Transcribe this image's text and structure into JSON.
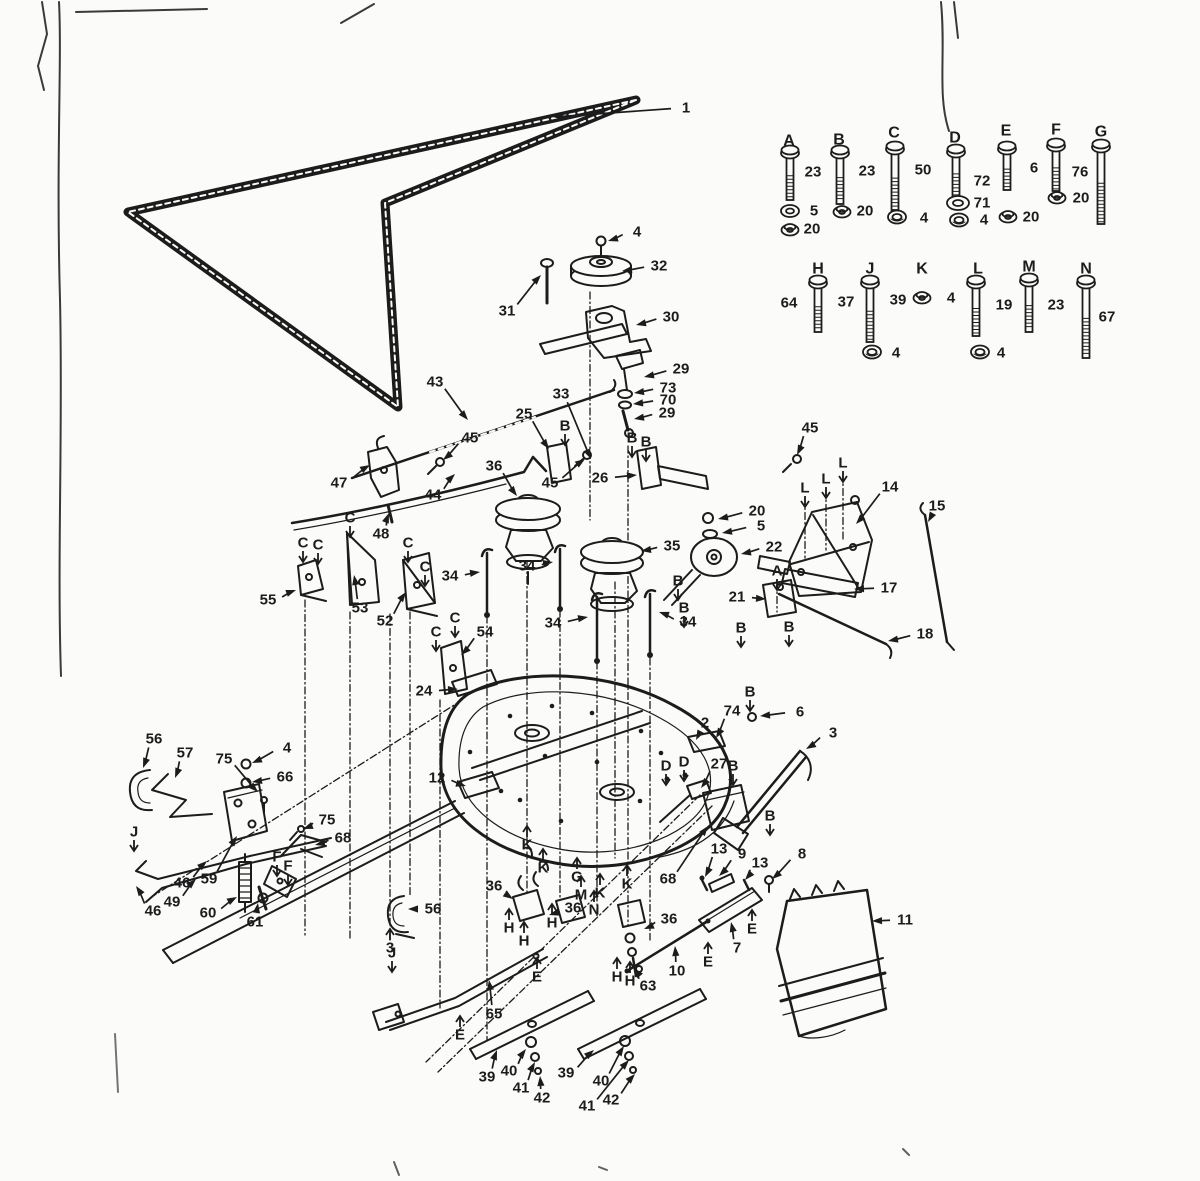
{
  "colors": {
    "ink": "#1c1c1c",
    "paper": "#fbfbf9",
    "scan": "#3a3a3a"
  },
  "legend": {
    "letters": [
      {
        "t": "A",
        "x": 789,
        "y": 141
      },
      {
        "t": "B",
        "x": 839,
        "y": 140
      },
      {
        "t": "C",
        "x": 894,
        "y": 133
      },
      {
        "t": "D",
        "x": 955,
        "y": 138
      },
      {
        "t": "E",
        "x": 1006,
        "y": 131
      },
      {
        "t": "F",
        "x": 1056,
        "y": 130
      },
      {
        "t": "G",
        "x": 1101,
        "y": 132
      },
      {
        "t": "H",
        "x": 818,
        "y": 269
      },
      {
        "t": "J",
        "x": 870,
        "y": 269
      },
      {
        "t": "K",
        "x": 922,
        "y": 269
      },
      {
        "t": "L",
        "x": 978,
        "y": 269
      },
      {
        "t": "M",
        "x": 1029,
        "y": 267
      },
      {
        "t": "N",
        "x": 1086,
        "y": 269
      }
    ],
    "numbers": [
      {
        "t": "23",
        "x": 813,
        "y": 172
      },
      {
        "t": "5",
        "x": 814,
        "y": 211
      },
      {
        "t": "20",
        "x": 812,
        "y": 229
      },
      {
        "t": "23",
        "x": 867,
        "y": 171
      },
      {
        "t": "20",
        "x": 865,
        "y": 211
      },
      {
        "t": "50",
        "x": 923,
        "y": 170
      },
      {
        "t": "4",
        "x": 924,
        "y": 218
      },
      {
        "t": "72",
        "x": 982,
        "y": 181
      },
      {
        "t": "71",
        "x": 982,
        "y": 203
      },
      {
        "t": "4",
        "x": 984,
        "y": 220
      },
      {
        "t": "6",
        "x": 1034,
        "y": 168
      },
      {
        "t": "20",
        "x": 1031,
        "y": 217
      },
      {
        "t": "76",
        "x": 1080,
        "y": 172
      },
      {
        "t": "20",
        "x": 1081,
        "y": 198
      },
      {
        "t": "64",
        "x": 789,
        "y": 303
      },
      {
        "t": "37",
        "x": 846,
        "y": 302
      },
      {
        "t": "39",
        "x": 898,
        "y": 300
      },
      {
        "t": "4",
        "x": 951,
        "y": 298
      },
      {
        "t": "19",
        "x": 1004,
        "y": 305
      },
      {
        "t": "23",
        "x": 1056,
        "y": 305
      },
      {
        "t": "67",
        "x": 1107,
        "y": 317
      },
      {
        "t": "4",
        "x": 896,
        "y": 353
      },
      {
        "t": "4",
        "x": 1001,
        "y": 353
      }
    ],
    "icons": [
      {
        "k": "bolt",
        "x": 790,
        "y": 152,
        "len": 44
      },
      {
        "k": "washer",
        "x": 790,
        "y": 211
      },
      {
        "k": "locknut",
        "x": 790,
        "y": 229
      },
      {
        "k": "bolt",
        "x": 840,
        "y": 152,
        "len": 48
      },
      {
        "k": "locknut",
        "x": 842,
        "y": 211
      },
      {
        "k": "bolt",
        "x": 895,
        "y": 148,
        "len": 58
      },
      {
        "k": "nut",
        "x": 897,
        "y": 217
      },
      {
        "k": "bolt",
        "x": 956,
        "y": 151,
        "len": 42
      },
      {
        "k": "flatwasher",
        "x": 958,
        "y": 203
      },
      {
        "k": "nut",
        "x": 959,
        "y": 220
      },
      {
        "k": "bolt",
        "x": 1007,
        "y": 148,
        "len": 38
      },
      {
        "k": "locknut",
        "x": 1008,
        "y": 216
      },
      {
        "k": "bolt",
        "x": 1056,
        "y": 145,
        "len": 42
      },
      {
        "k": "locknut",
        "x": 1057,
        "y": 197
      },
      {
        "k": "bolt",
        "x": 1101,
        "y": 146,
        "len": 74
      },
      {
        "k": "bolt",
        "x": 818,
        "y": 282,
        "len": 46
      },
      {
        "k": "bolt",
        "x": 870,
        "y": 282,
        "len": 56
      },
      {
        "k": "nut",
        "x": 872,
        "y": 352
      },
      {
        "k": "locknut",
        "x": 922,
        "y": 297
      },
      {
        "k": "bolt",
        "x": 976,
        "y": 282,
        "len": 50
      },
      {
        "k": "nut",
        "x": 980,
        "y": 352
      },
      {
        "k": "bolt",
        "x": 1029,
        "y": 280,
        "len": 48
      },
      {
        "k": "bolt",
        "x": 1086,
        "y": 282,
        "len": 72
      }
    ]
  },
  "callouts": [
    {
      "t": "1",
      "x": 686,
      "y": 108,
      "lx": 553,
      "ly": 117
    },
    {
      "t": "4",
      "x": 637,
      "y": 232,
      "lx": 608,
      "ly": 241
    },
    {
      "t": "32",
      "x": 659,
      "y": 266,
      "lx": 622,
      "ly": 271
    },
    {
      "t": "31",
      "x": 507,
      "y": 311,
      "lx": 541,
      "ly": 275
    },
    {
      "t": "30",
      "x": 671,
      "y": 317,
      "lx": 636,
      "ly": 325
    },
    {
      "t": "29",
      "x": 681,
      "y": 369,
      "lx": 644,
      "ly": 377
    },
    {
      "t": "73",
      "x": 668,
      "y": 388,
      "lx": 634,
      "ly": 393
    },
    {
      "t": "70",
      "x": 668,
      "y": 400,
      "lx": 633,
      "ly": 404
    },
    {
      "t": "29",
      "x": 667,
      "y": 413,
      "lx": 634,
      "ly": 419
    },
    {
      "t": "33",
      "x": 561,
      "y": 394,
      "lx": 591,
      "ly": 459
    },
    {
      "t": "25",
      "x": 524,
      "y": 414,
      "lx": 549,
      "ly": 449
    },
    {
      "t": "43",
      "x": 435,
      "y": 382,
      "lx": 468,
      "ly": 420
    },
    {
      "t": "45",
      "x": 470,
      "y": 438,
      "lx": 443,
      "ly": 460
    },
    {
      "t": "36",
      "x": 494,
      "y": 466,
      "lx": 517,
      "ly": 496
    },
    {
      "t": "44",
      "x": 433,
      "y": 495,
      "lx": 455,
      "ly": 474
    },
    {
      "t": "47",
      "x": 339,
      "y": 483,
      "lx": 370,
      "ly": 465
    },
    {
      "t": "48",
      "x": 381,
      "y": 534,
      "lx": 389,
      "ly": 513
    },
    {
      "t": "26",
      "x": 600,
      "y": 478,
      "lx": 637,
      "ly": 475
    },
    {
      "t": "45",
      "x": 550,
      "y": 483,
      "lx": 585,
      "ly": 459
    },
    {
      "t": "45",
      "x": 810,
      "y": 428,
      "lx": 797,
      "ly": 455
    },
    {
      "t": "14",
      "x": 890,
      "y": 487,
      "lx": 856,
      "ly": 524
    },
    {
      "t": "15",
      "x": 937,
      "y": 506,
      "lx": 928,
      "ly": 522
    },
    {
      "t": "17",
      "x": 889,
      "y": 588,
      "lx": 854,
      "ly": 589
    },
    {
      "t": "18",
      "x": 925,
      "y": 634,
      "lx": 888,
      "ly": 641
    },
    {
      "t": "21",
      "x": 737,
      "y": 597,
      "lx": 766,
      "ly": 599
    },
    {
      "t": "22",
      "x": 774,
      "y": 547,
      "lx": 741,
      "ly": 554
    },
    {
      "t": "5",
      "x": 761,
      "y": 526,
      "lx": 722,
      "ly": 533
    },
    {
      "t": "20",
      "x": 757,
      "y": 511,
      "lx": 718,
      "ly": 519
    },
    {
      "t": "35",
      "x": 672,
      "y": 546,
      "lx": 641,
      "ly": 551
    },
    {
      "t": "34",
      "x": 450,
      "y": 576,
      "lx": 480,
      "ly": 572
    },
    {
      "t": "34",
      "x": 527,
      "y": 566,
      "lx": 553,
      "ly": 562
    },
    {
      "t": "34",
      "x": 553,
      "y": 623,
      "lx": 588,
      "ly": 617
    },
    {
      "t": "34",
      "x": 688,
      "y": 622,
      "lx": 659,
      "ly": 612
    },
    {
      "t": "55",
      "x": 268,
      "y": 600,
      "lx": 296,
      "ly": 590
    },
    {
      "t": "53",
      "x": 360,
      "y": 608,
      "lx": 354,
      "ly": 575
    },
    {
      "t": "52",
      "x": 385,
      "y": 621,
      "lx": 406,
      "ly": 592
    },
    {
      "t": "54",
      "x": 485,
      "y": 632,
      "lx": 461,
      "ly": 655
    },
    {
      "t": "24",
      "x": 424,
      "y": 691,
      "lx": 458,
      "ly": 689
    },
    {
      "t": "12",
      "x": 437,
      "y": 778,
      "lx": 466,
      "ly": 786
    },
    {
      "t": "2",
      "x": 705,
      "y": 723,
      "lx": 696,
      "ly": 740
    },
    {
      "t": "74",
      "x": 732,
      "y": 711,
      "lx": 716,
      "ly": 738
    },
    {
      "t": "6",
      "x": 800,
      "y": 712,
      "lx": 760,
      "ly": 716
    },
    {
      "t": "27",
      "x": 719,
      "y": 764,
      "lx": 701,
      "ly": 788
    },
    {
      "t": "3",
      "x": 833,
      "y": 733,
      "lx": 806,
      "ly": 749
    },
    {
      "t": "68",
      "x": 668,
      "y": 879,
      "lx": 708,
      "ly": 826
    },
    {
      "t": "13",
      "x": 719,
      "y": 849,
      "lx": 705,
      "ly": 877
    },
    {
      "t": "9",
      "x": 742,
      "y": 854,
      "lx": 719,
      "ly": 876
    },
    {
      "t": "13",
      "x": 760,
      "y": 863,
      "lx": 745,
      "ly": 880
    },
    {
      "t": "8",
      "x": 802,
      "y": 854,
      "lx": 772,
      "ly": 879
    },
    {
      "t": "11",
      "x": 905,
      "y": 920,
      "lx": 872,
      "ly": 921
    },
    {
      "t": "7",
      "x": 737,
      "y": 948,
      "lx": 731,
      "ly": 922
    },
    {
      "t": "10",
      "x": 677,
      "y": 971,
      "lx": 675,
      "ly": 946
    },
    {
      "t": "36",
      "x": 494,
      "y": 886,
      "lx": 513,
      "ly": 899
    },
    {
      "t": "36",
      "x": 573,
      "y": 908,
      "lx": 549,
      "ly": 915
    },
    {
      "t": "36",
      "x": 669,
      "y": 919,
      "lx": 644,
      "ly": 929
    },
    {
      "t": "63",
      "x": 648,
      "y": 986,
      "lx": 634,
      "ly": 968
    },
    {
      "t": "65",
      "x": 494,
      "y": 1014,
      "lx": 489,
      "ly": 980
    },
    {
      "t": "56",
      "x": 154,
      "y": 739,
      "lx": 143,
      "ly": 768
    },
    {
      "t": "57",
      "x": 185,
      "y": 753,
      "lx": 175,
      "ly": 778
    },
    {
      "t": "75",
      "x": 224,
      "y": 759,
      "lx": 258,
      "ly": 792
    },
    {
      "t": "4",
      "x": 287,
      "y": 748,
      "lx": 252,
      "ly": 763
    },
    {
      "t": "66",
      "x": 285,
      "y": 777,
      "lx": 252,
      "ly": 782
    },
    {
      "t": "75",
      "x": 327,
      "y": 820,
      "lx": 303,
      "ly": 829
    },
    {
      "t": "68",
      "x": 343,
      "y": 838,
      "lx": 315,
      "ly": 845
    },
    {
      "t": "59",
      "x": 209,
      "y": 879,
      "lx": 237,
      "ly": 836
    },
    {
      "t": "46",
      "x": 182,
      "y": 883,
      "lx": 207,
      "ly": 861
    },
    {
      "t": "49",
      "x": 172,
      "y": 902,
      "lx": 196,
      "ly": 879
    },
    {
      "t": "46",
      "x": 153,
      "y": 911,
      "lx": 136,
      "ly": 886
    },
    {
      "t": "60",
      "x": 208,
      "y": 913,
      "lx": 237,
      "ly": 897
    },
    {
      "t": "61",
      "x": 255,
      "y": 922,
      "lx": 258,
      "ly": 903
    },
    {
      "t": "56",
      "x": 433,
      "y": 909,
      "lx": 408,
      "ly": 909
    },
    {
      "t": "3",
      "x": 390,
      "y": 948,
      "dir": "u"
    },
    {
      "t": "39",
      "x": 487,
      "y": 1077,
      "lx": 497,
      "ly": 1050
    },
    {
      "t": "40",
      "x": 509,
      "y": 1071,
      "lx": 526,
      "ly": 1049
    },
    {
      "t": "41",
      "x": 521,
      "y": 1088,
      "lx": 535,
      "ly": 1062
    },
    {
      "t": "42",
      "x": 542,
      "y": 1098,
      "lx": 540,
      "ly": 1076
    },
    {
      "t": "39",
      "x": 566,
      "y": 1073,
      "lx": 594,
      "ly": 1050
    },
    {
      "t": "40",
      "x": 601,
      "y": 1081,
      "lx": 624,
      "ly": 1046
    },
    {
      "t": "41",
      "x": 587,
      "y": 1106,
      "lx": 629,
      "ly": 1060
    },
    {
      "t": "42",
      "x": 611,
      "y": 1100,
      "lx": 635,
      "ly": 1074
    },
    {
      "t": "B",
      "x": 565,
      "y": 426,
      "dir": "d"
    },
    {
      "t": "B",
      "x": 632,
      "y": 438,
      "dir": "d"
    },
    {
      "t": "B",
      "x": 646,
      "y": 442,
      "dir": "d"
    },
    {
      "t": "B",
      "x": 750,
      "y": 692,
      "dir": "d"
    },
    {
      "t": "B",
      "x": 733,
      "y": 766,
      "dir": "d"
    },
    {
      "t": "B",
      "x": 678,
      "y": 581,
      "dir": "d"
    },
    {
      "t": "B",
      "x": 684,
      "y": 608,
      "dir": "d"
    },
    {
      "t": "B",
      "x": 741,
      "y": 628,
      "dir": "d"
    },
    {
      "t": "B",
      "x": 789,
      "y": 627,
      "dir": "d"
    },
    {
      "t": "B",
      "x": 770,
      "y": 816,
      "dir": "d"
    },
    {
      "t": "A",
      "x": 777,
      "y": 571,
      "dir": "d"
    },
    {
      "t": "D",
      "x": 666,
      "y": 766,
      "dir": "d"
    },
    {
      "t": "D",
      "x": 684,
      "y": 762,
      "dir": "d"
    },
    {
      "t": "C",
      "x": 303,
      "y": 543,
      "dir": "d"
    },
    {
      "t": "C",
      "x": 318,
      "y": 545,
      "dir": "d"
    },
    {
      "t": "C",
      "x": 350,
      "y": 518,
      "dir": "d"
    },
    {
      "t": "C",
      "x": 408,
      "y": 543,
      "dir": "d"
    },
    {
      "t": "C",
      "x": 425,
      "y": 567,
      "dir": "d"
    },
    {
      "t": "C",
      "x": 436,
      "y": 632,
      "dir": "d"
    },
    {
      "t": "C",
      "x": 455,
      "y": 618,
      "dir": "d"
    },
    {
      "t": "L",
      "x": 805,
      "y": 488,
      "dir": "d"
    },
    {
      "t": "L",
      "x": 826,
      "y": 479,
      "dir": "d"
    },
    {
      "t": "L",
      "x": 843,
      "y": 463,
      "dir": "d"
    },
    {
      "t": "K",
      "x": 527,
      "y": 845,
      "dir": "u"
    },
    {
      "t": "K",
      "x": 543,
      "y": 868,
      "dir": "u"
    },
    {
      "t": "K",
      "x": 627,
      "y": 884,
      "dir": "u"
    },
    {
      "t": "K",
      "x": 600,
      "y": 893,
      "dir": "u"
    },
    {
      "t": "G",
      "x": 577,
      "y": 877,
      "dir": "u"
    },
    {
      "t": "M",
      "x": 581,
      "y": 895,
      "dir": "u"
    },
    {
      "t": "N",
      "x": 594,
      "y": 910,
      "dir": "u"
    },
    {
      "t": "H",
      "x": 509,
      "y": 928,
      "dir": "u"
    },
    {
      "t": "H",
      "x": 552,
      "y": 923,
      "dir": "u"
    },
    {
      "t": "H",
      "x": 524,
      "y": 941,
      "dir": "u"
    },
    {
      "t": "H",
      "x": 617,
      "y": 977,
      "dir": "u"
    },
    {
      "t": "H",
      "x": 630,
      "y": 981,
      "dir": "u"
    },
    {
      "t": "E",
      "x": 752,
      "y": 929,
      "dir": "u"
    },
    {
      "t": "E",
      "x": 708,
      "y": 962,
      "dir": "u"
    },
    {
      "t": "E",
      "x": 537,
      "y": 977,
      "dir": "u"
    },
    {
      "t": "E",
      "x": 460,
      "y": 1035,
      "dir": "u"
    },
    {
      "t": "F",
      "x": 277,
      "y": 857,
      "dir": "d"
    },
    {
      "t": "F",
      "x": 288,
      "y": 866,
      "dir": "d"
    },
    {
      "t": "J",
      "x": 134,
      "y": 832,
      "dir": "d"
    },
    {
      "t": "J",
      "x": 392,
      "y": 953,
      "dir": "d"
    }
  ]
}
